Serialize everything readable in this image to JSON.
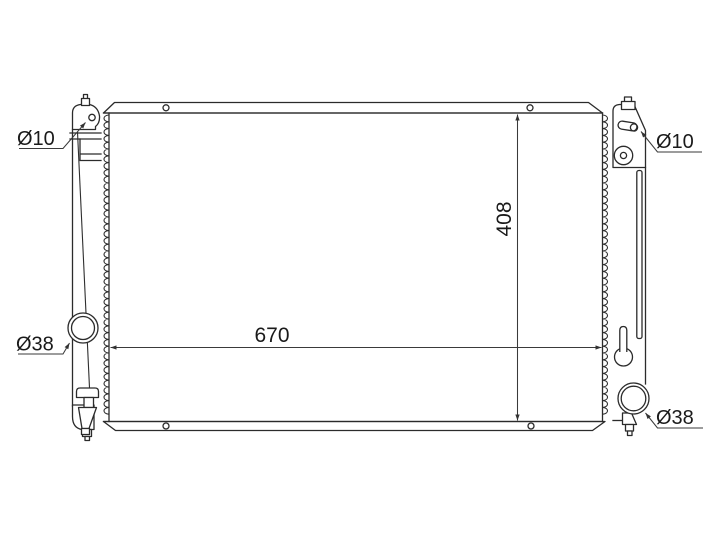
{
  "colors": {
    "background": "#ffffff",
    "line": "#2b2b2b",
    "text": "#1a1a1a"
  },
  "drawing": {
    "annotations": {
      "core_width": "670",
      "core_height": "408",
      "left_mount_hole": "Ø10",
      "right_mount_hole": "Ø10",
      "left_port": "Ø38",
      "right_port": "Ø38"
    }
  }
}
